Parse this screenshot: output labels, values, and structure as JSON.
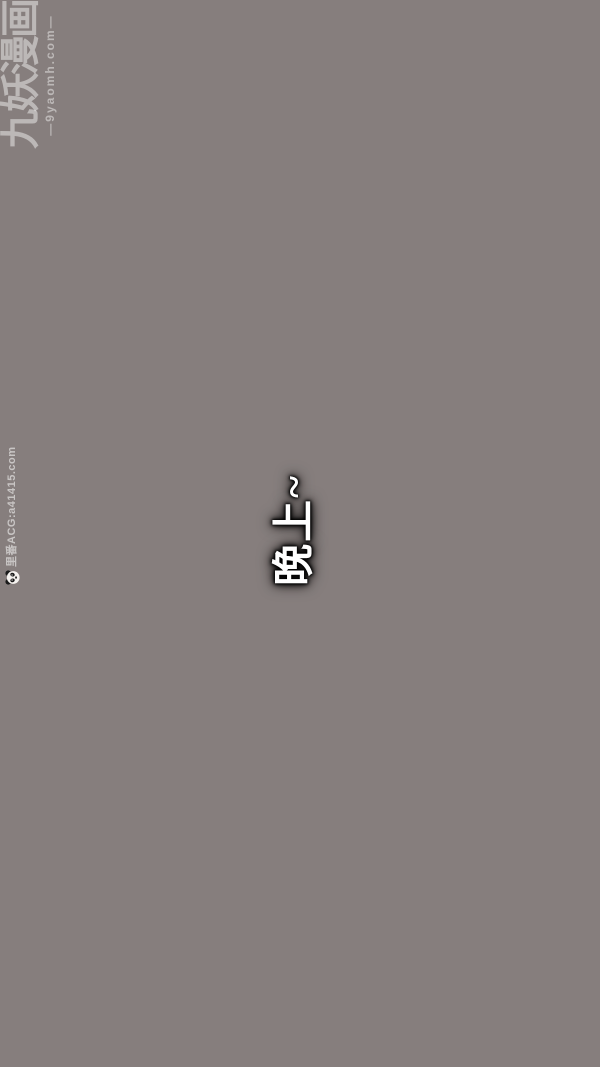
{
  "page": {
    "background_color": "#867e7d"
  },
  "watermarks": {
    "site_logo": {
      "title": "九妖漫画",
      "domain": "—9yaomh.com—",
      "text_color": "#bcb5b1",
      "rotation": "-90deg"
    },
    "side": {
      "icon": "panda-icon",
      "label": "里番ACG:a41415.com",
      "text_color": "#b3aca9",
      "rotation": "-90deg"
    }
  },
  "dialogue": {
    "text": "晚上~",
    "text_color": "#ffffff",
    "outline_color": "#000000",
    "rotation": "-90deg"
  }
}
